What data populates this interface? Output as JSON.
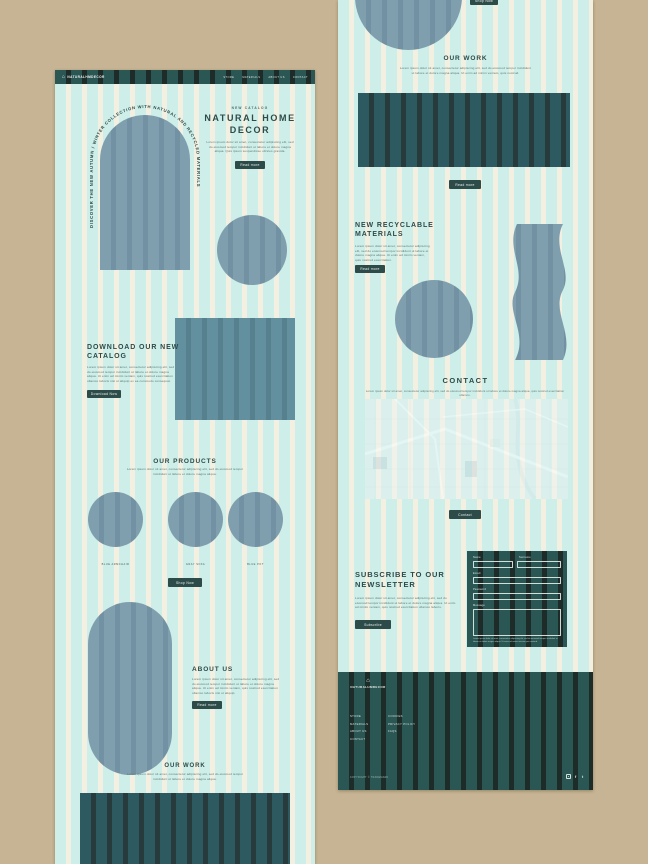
{
  "brand": {
    "logo_text": "NATURALHMDECOR",
    "logo_icon": "home-icon"
  },
  "nav": {
    "links": [
      "STORE",
      "MATERIALS",
      "ABOUT US",
      "CONTACT"
    ]
  },
  "hero": {
    "arc_text": "DISCOVER THE NEW AUTUMN / WINTER COLLECTION WITH NATURAL AND RECYCLED MATERIALS",
    "eyebrow": "NEW CATALOG",
    "title": "NATURAL HOME DECOR",
    "body": "Lorem ipsum dolor sit amet, consectetur adipiscing elit, sed do eiusmod tempor incididunt ut labore et dolore magna aliqua. Quis ipsum suspendisse ultrices gravida.",
    "cta": "Read more"
  },
  "catalog": {
    "title": "DOWNLOAD OUR NEW CATALOG",
    "body": "Lorem ipsum dolor sit amet, consectetur adipiscing elit, sed do eiusmod tempor incididunt ut labore et dolore magna aliqua. Ut enim ad minim veniam, quis nostrud exercitation ullamco laboris nisi ut aliquip ex ea commodo consequat.",
    "cta": "Download Now"
  },
  "products": {
    "title": "OUR PRODUCTS",
    "body": "Lorem ipsum dolor sit amet, consectetur adipiscing elit, sed do eiusmod tempor incididunt ut labore et dolore magna aliqua.",
    "items": [
      "BLUE ARMCHAIR",
      "GRAY SOFA",
      "BLUE POT"
    ],
    "cta": "Shop Now"
  },
  "about": {
    "title": "ABOUT US",
    "body": "Lorem ipsum dolor sit amet, consectetur adipiscing elit, sed do eiusmod tempor incididunt ut labore et dolore magna aliqua. Ut enim ad minim veniam, quis nostrud exercitation ullamco laboris nisi ut aliquip.",
    "cta": "Read more"
  },
  "work_left": {
    "title": "OUR WORK",
    "body": "Lorem ipsum dolor sit amet, consectetur adipiscing elit, sed do eiusmod tempor incididunt ut labore et dolore magna aliqua."
  },
  "page2": {
    "top_cta": "Shop Now",
    "work": {
      "title": "OUR WORK",
      "body": "Lorem ipsum dolor sit amet, consectetur adipiscing elit, sed do eiusmod tempor incididunt ut labore et dolore magna aliqua. Ut enim ad minim veniam, quis nostrud.",
      "cta": "Read more"
    },
    "materials": {
      "title": "NEW RECYCLABLE MATERIALS",
      "body": "Lorem ipsum dolor sit amet, consectetur adipiscing elit, sed do eiusmod tempor incididunt ut labore et dolore magna aliqua. Ut enim ad minim veniam, quis nostrud exercitation.",
      "cta": "Read more"
    },
    "contact": {
      "title": "CONTACT",
      "body": "Lorem ipsum dolor sit amet, consectetur adipiscing elit, sed do eiusmod tempor incididunt ut labore et dolore magna aliqua, quis nostrud exercitation ullamco.",
      "cta": "Contact"
    },
    "newsletter": {
      "title": "SUBSCRIBE TO OUR NEWSLETTER",
      "body": "Lorem ipsum dolor sit amet, consectetur adipiscing elit, sed do eiusmod tempor incididunt ut labore et dolore magna aliqua. Ut enim ad minim veniam, quis nostrud exercitation ullamco laboris.",
      "cta": "Subscribe",
      "form": {
        "name_label": "Name",
        "surname_label": "Surname",
        "email_label": "Email",
        "password_label": "Password",
        "message_label": "Message",
        "disclaimer": "Lorem ipsum dolor sit amet, consectetur adipiscing elit, sed do eiusmod tempor incididunt ut labore et dolore magna aliqua. Ut enim ad minim veniam quis nostrud."
      }
    },
    "footer": {
      "links_col1": [
        "STORE",
        "MATERIALS",
        "ABOUT US",
        "CONTACT"
      ],
      "links_col2": [
        "COOKIES",
        "PRIVACY POLICY",
        "FAQS"
      ],
      "copyright": "COPYRIGHT © TRADEMARK",
      "social": [
        "instagram-icon",
        "facebook-icon",
        "twitter-icon"
      ]
    }
  },
  "colors": {
    "background_tan": "#c6b494",
    "dark_teal": "#2a4f4c",
    "mint_stripe": "#cdeee9",
    "cream_stripe": "#f3f0e2",
    "shape_blue_gray": "#7d9eae",
    "heading_text": "#2e4b49"
  }
}
